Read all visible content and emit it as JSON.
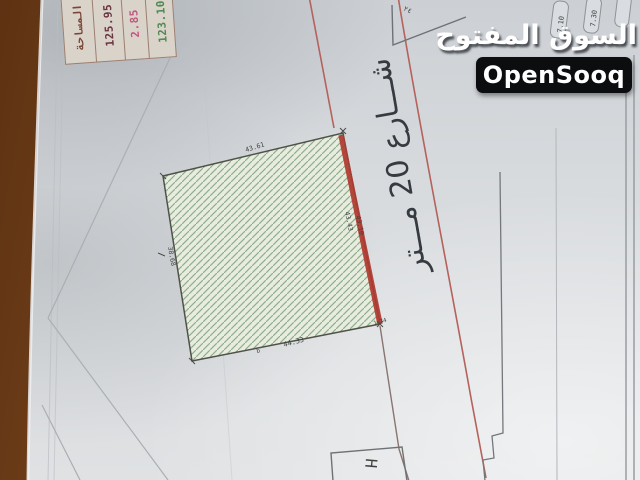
{
  "watermark": {
    "arabic": "السوق المفتوح",
    "latin": "OpenSooq",
    "box_color": "#0c0d0f",
    "text_color": "#ffffff"
  },
  "survey_table": {
    "row_label": "المساحة",
    "values": [
      {
        "text": "125.95",
        "color": "#6b3540"
      },
      {
        "text": "2.85",
        "color": "#c2577e"
      },
      {
        "text": "123.10",
        "color": "#4e8a52"
      }
    ]
  },
  "map": {
    "street_label": "شـــارع 20 مـــتر",
    "dims": {
      "top": "43.61",
      "bottom": "44.33",
      "left": "38.68",
      "right_a": "43.43",
      "right_b": "43.10",
      "corner": "1.74"
    },
    "point_mark": "b",
    "corner_mark": "٢٤",
    "building_mark": "H",
    "neighbor_plots": [
      "7.10",
      "7.30"
    ],
    "colors": {
      "plot_fill": "#e7ecdf",
      "plot_hatch": "#8fae8d",
      "plot_border": "#50524a",
      "road_edge": "#b03a30",
      "road_line": "#b5625c",
      "paper": "#d8dbde",
      "wood_background": "#8a5424"
    }
  }
}
